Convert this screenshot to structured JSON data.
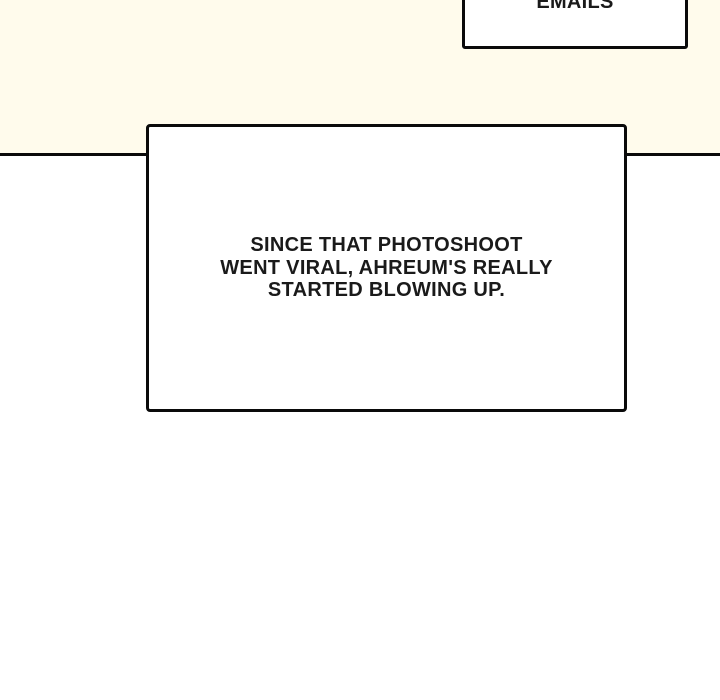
{
  "page": {
    "background_color": "#ffffff",
    "panel_background_color": "#fffbec",
    "line_color": "#0a0a0a",
    "caption_fill_color": "#ffffff",
    "text_color": "#1a1a1a"
  },
  "top_caption": {
    "text": "EMAILS"
  },
  "main_caption": {
    "text": "SINCE THAT PHOTOSHOOT\nWENT VIRAL, AHREUM'S REALLY\nSTARTED BLOWING UP."
  }
}
